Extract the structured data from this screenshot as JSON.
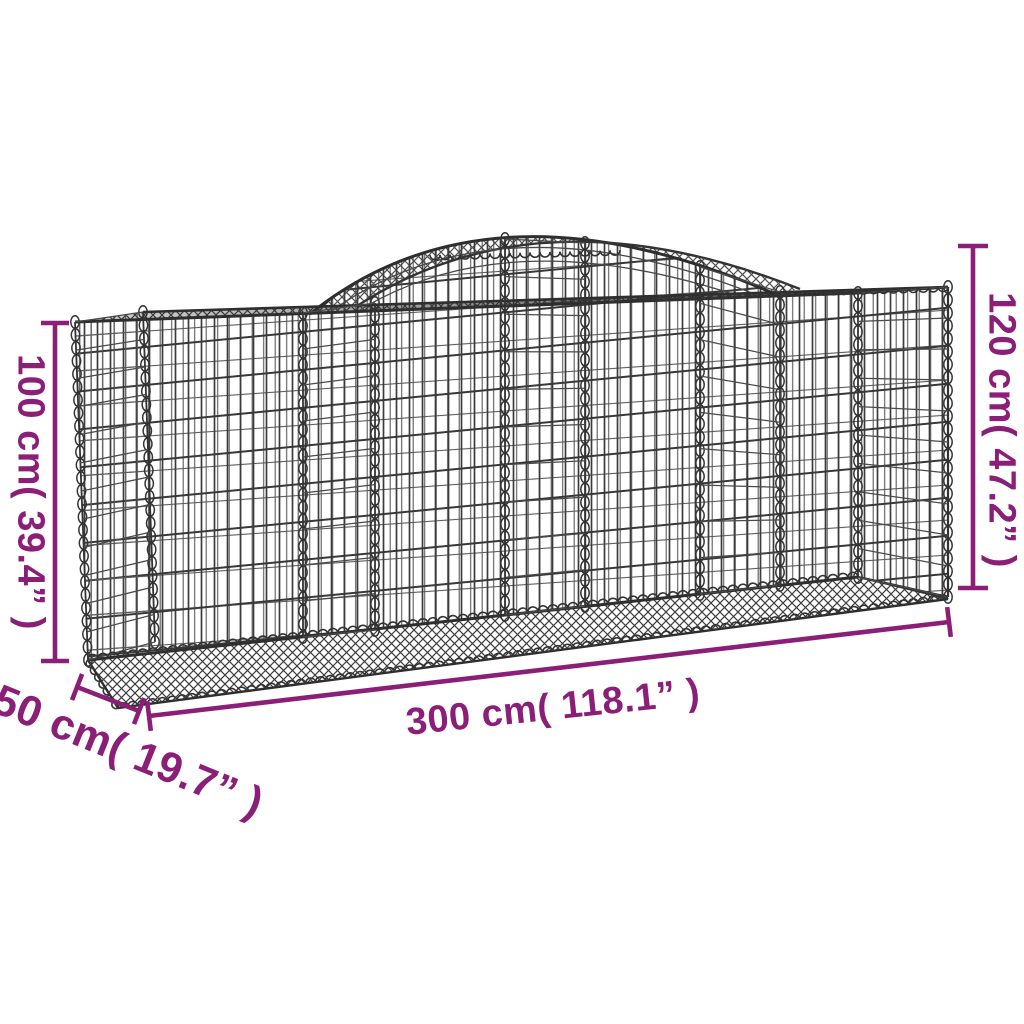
{
  "diagram": {
    "type": "product-dimension-diagram",
    "subject": "arched gabion mesh basket",
    "background_color": "#ffffff",
    "dimension_color": "#8B1E76",
    "wire_color": "#3a3a3a",
    "labels": {
      "height_left": "100 cm( 39.4” )",
      "height_right": "120 cm( 47.2” )",
      "length": "300 cm( 118.1” )",
      "depth": "50 cm( 19.7” )"
    }
  }
}
